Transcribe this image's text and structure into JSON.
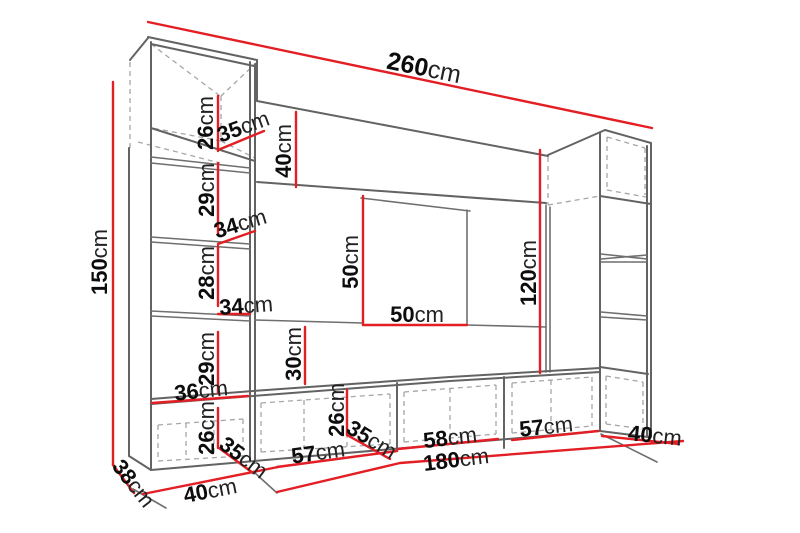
{
  "diagram": {
    "type": "furniture-wall-unit-dimension-diagram",
    "unit": "cm",
    "colors": {
      "dimension_line": "#e31e24",
      "outline": "#6f6f6f",
      "hidden_edge": "#a6a6a6",
      "label_text": "#0d0d0d",
      "background": "#ffffff"
    },
    "dimensions": {
      "total_width": {
        "value": "260",
        "unit": "cm"
      },
      "left_height": {
        "value": "150",
        "unit": "cm"
      },
      "topleft_cab_height": {
        "value": "26",
        "unit": "cm"
      },
      "topleft_cab_width": {
        "value": "35",
        "unit": "cm"
      },
      "top_shelf_height": {
        "value": "40",
        "unit": "cm"
      },
      "shelf1_height": {
        "value": "29",
        "unit": "cm"
      },
      "shelf1_width": {
        "value": "34",
        "unit": "cm"
      },
      "shelf2_height": {
        "value": "28",
        "unit": "cm"
      },
      "shelf2_width": {
        "value": "34",
        "unit": "cm"
      },
      "shelf3_height": {
        "value": "29",
        "unit": "cm"
      },
      "base_width": {
        "value": "36",
        "unit": "cm"
      },
      "base_cab_height": {
        "value": "26",
        "unit": "cm"
      },
      "base_cab_depth": {
        "value": "35",
        "unit": "cm"
      },
      "bottom_left_width": {
        "value": "40",
        "unit": "cm"
      },
      "left_depth": {
        "value": "38",
        "unit": "cm"
      },
      "stand_cab1_width": {
        "value": "57",
        "unit": "cm"
      },
      "stand_cab_height": {
        "value": "26",
        "unit": "cm"
      },
      "stand_cab_depth": {
        "value": "35",
        "unit": "cm"
      },
      "stand_cab2_width": {
        "value": "58",
        "unit": "cm"
      },
      "stand_width": {
        "value": "180",
        "unit": "cm"
      },
      "stand_cab3_width": {
        "value": "57",
        "unit": "cm"
      },
      "right_depth": {
        "value": "40",
        "unit": "cm"
      },
      "tv_panel_height": {
        "value": "50",
        "unit": "cm"
      },
      "tv_panel_width": {
        "value": "50",
        "unit": "cm"
      },
      "middle_gap_height": {
        "value": "30",
        "unit": "cm"
      },
      "right_opening_height": {
        "value": "120",
        "unit": "cm"
      }
    }
  }
}
